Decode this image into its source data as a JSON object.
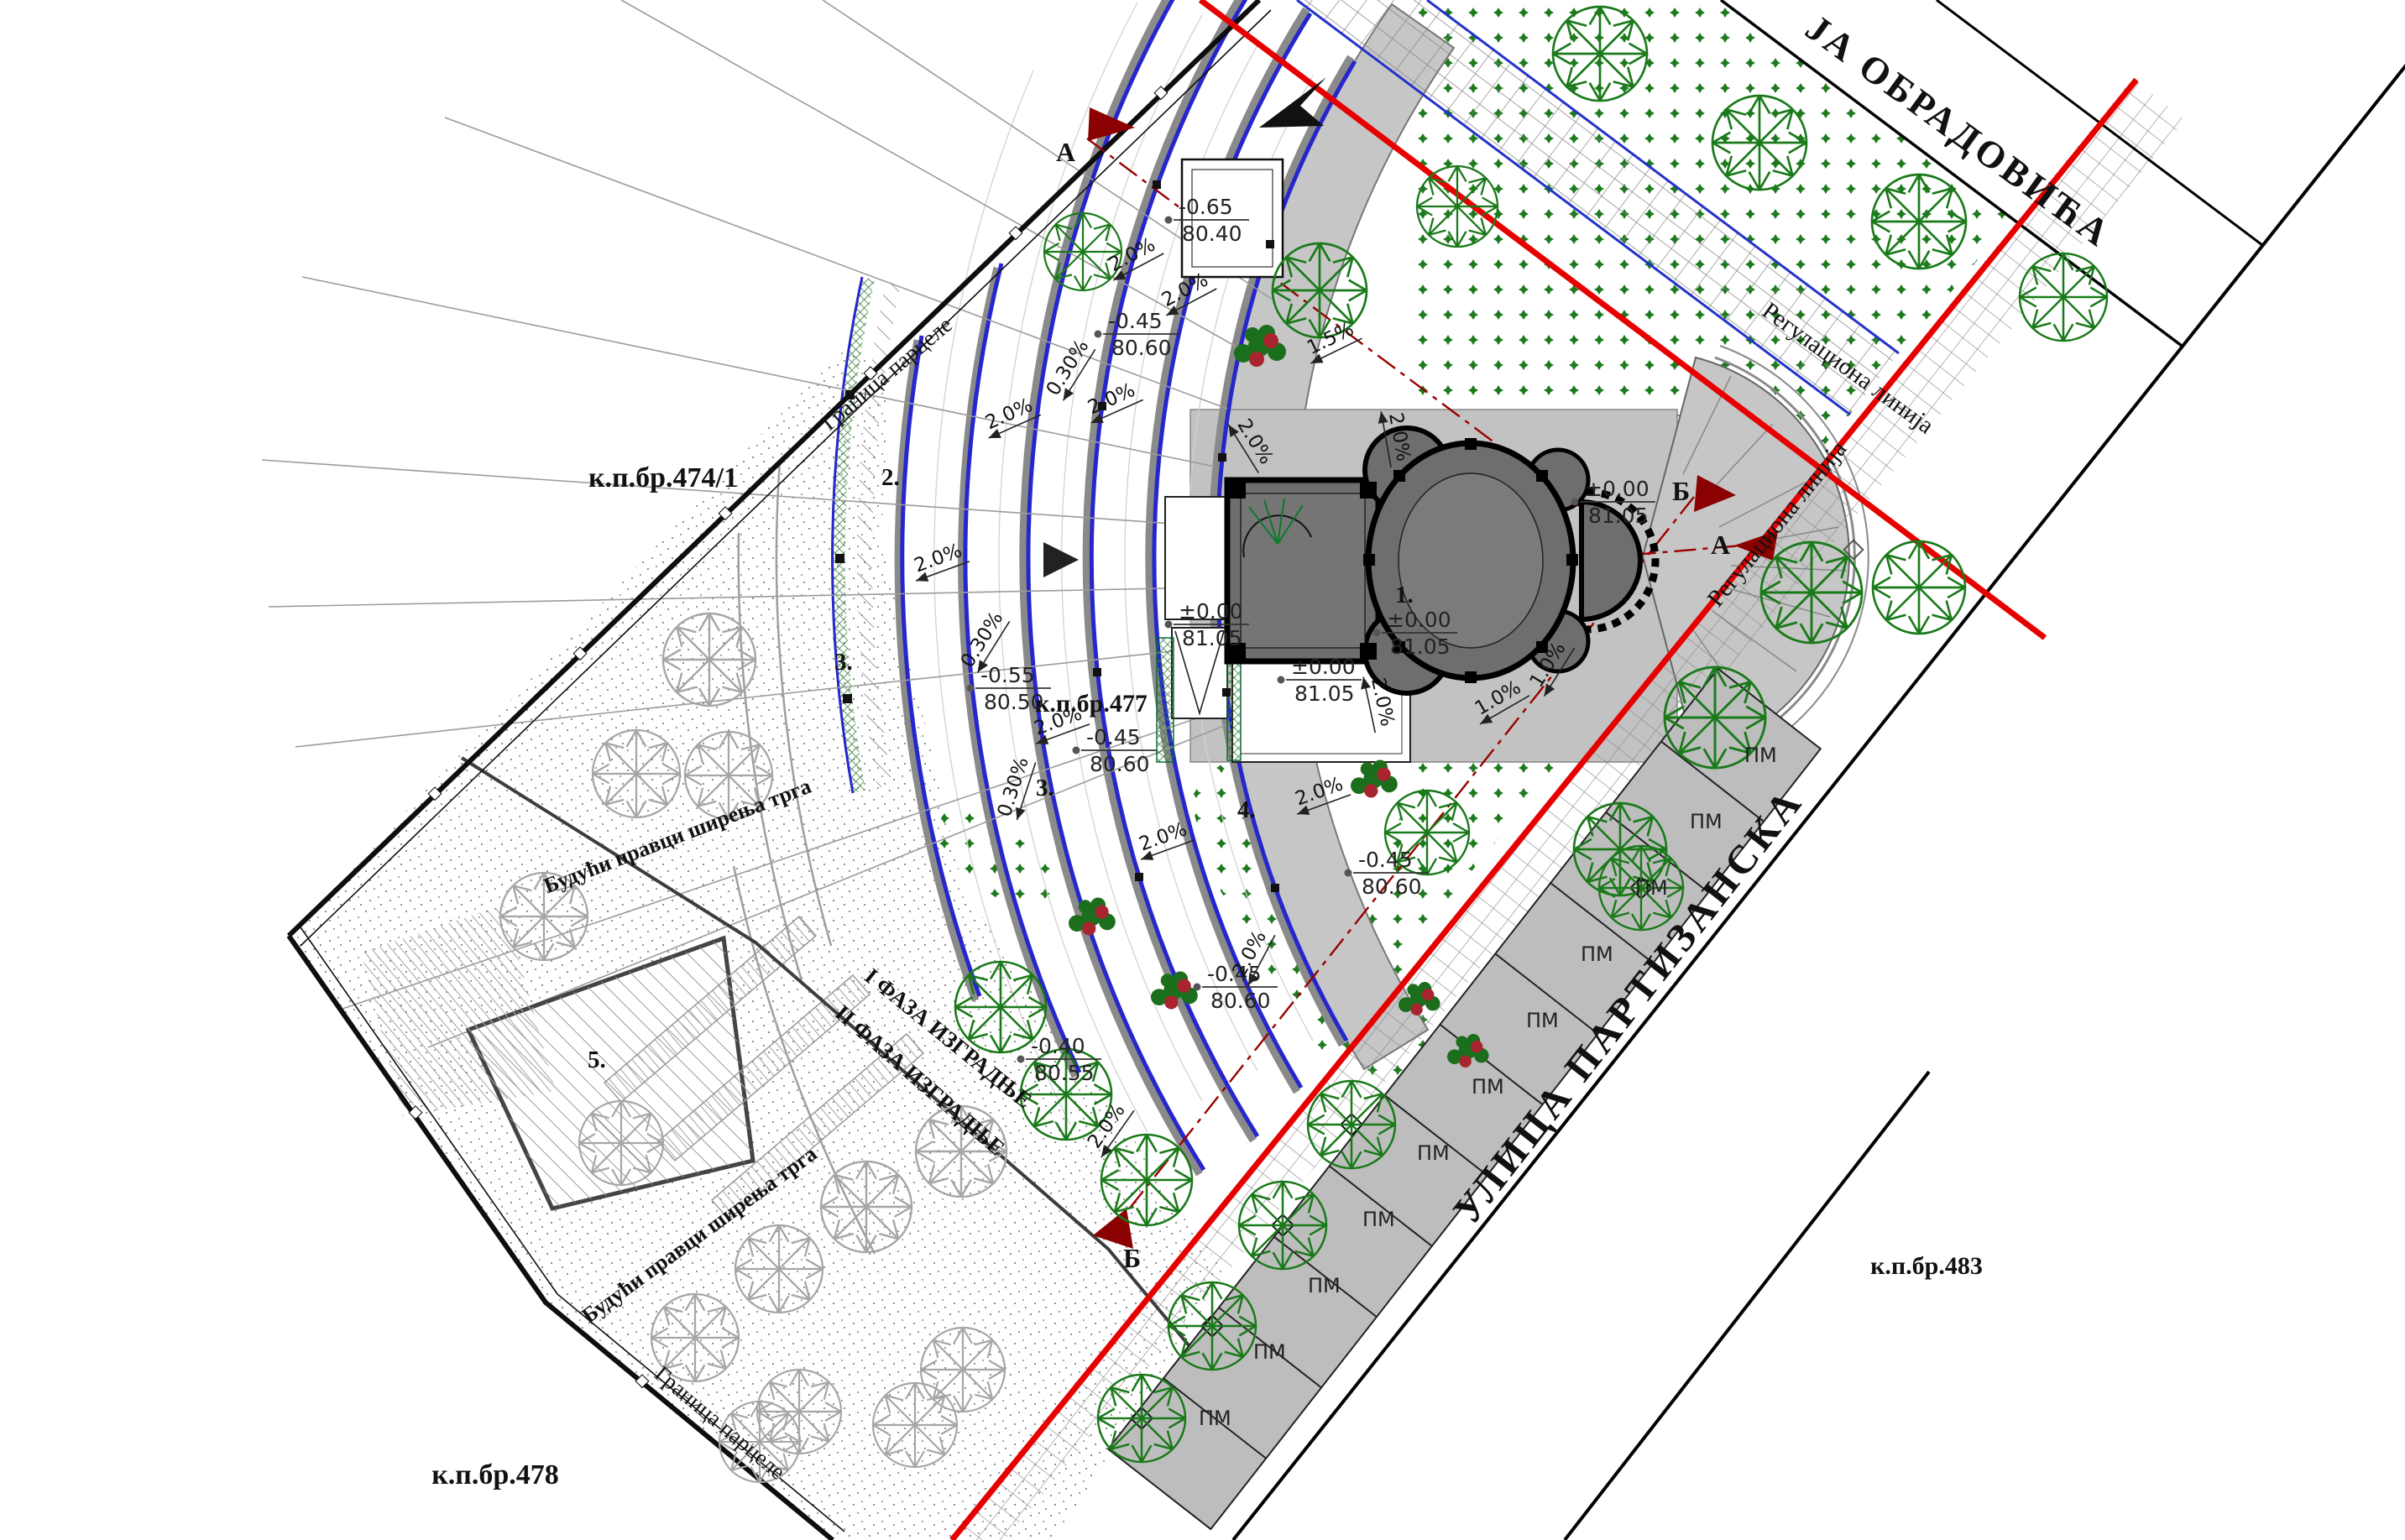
{
  "drawing": {
    "type": "site-plan",
    "subject": "church square landscaping plan"
  },
  "streets": {
    "top": {
      "label": "ЈА ОБРАДОВИЋА"
    },
    "right": {
      "label": "УЛИЦА ПАРТИЗАНСКА"
    }
  },
  "parcels": [
    {
      "label": "к.п.бр.474/1"
    },
    {
      "label": "к.п.бр.477"
    },
    {
      "label": "к.п.бр.478"
    },
    {
      "label": "к.п.бр.483"
    }
  ],
  "regulation_lines": [
    {
      "label": "Регулациона линија"
    },
    {
      "label": "Регулациона линија"
    }
  ],
  "boundary_labels": [
    {
      "label": "Граница парцеле"
    },
    {
      "label": "Граница парцеле"
    }
  ],
  "phases": [
    {
      "label": "I ФАЗА ИЗГРАДЊЕ"
    },
    {
      "label": "II ФАЗА ИЗГРАДЊЕ"
    }
  ],
  "future_directions": [
    {
      "label": "Будући правци ширења трга"
    },
    {
      "label": "Будући правци ширења трга"
    }
  ],
  "area_numbers": [
    {
      "label": "1."
    },
    {
      "label": "2."
    },
    {
      "label": "3."
    },
    {
      "label": "3."
    },
    {
      "label": "4."
    },
    {
      "label": "5."
    }
  ],
  "sections": [
    {
      "label": "А"
    },
    {
      "label": "А"
    },
    {
      "label": "Б"
    },
    {
      "label": "Б"
    }
  ],
  "parking": {
    "stall_label": "ПМ",
    "count": 11
  },
  "elevations": [
    {
      "rel": "-0.65",
      "abs": "80.40"
    },
    {
      "rel": "-0.45",
      "abs": "80.60"
    },
    {
      "rel": "-0.55",
      "abs": "80.50"
    },
    {
      "rel": "-0.45",
      "abs": "80.60"
    },
    {
      "rel": "±0.00",
      "abs": "81.05"
    },
    {
      "rel": "±0.00",
      "abs": "81.05"
    },
    {
      "rel": "±0.00",
      "abs": "81.05"
    },
    {
      "rel": "±0.00",
      "abs": "81.05"
    },
    {
      "rel": "-0.40",
      "abs": "80.55"
    },
    {
      "rel": "-0.45",
      "abs": "80.60"
    },
    {
      "rel": "-0.45",
      "abs": "80.60"
    }
  ],
  "slopes": [
    {
      "label": "2.0%"
    },
    {
      "label": "2.0%"
    },
    {
      "label": "0.30%"
    },
    {
      "label": "2.0%"
    },
    {
      "label": "2.0%"
    },
    {
      "label": "0.30%"
    },
    {
      "label": "2.0%"
    },
    {
      "label": "2.0%"
    },
    {
      "label": "2.0%"
    },
    {
      "label": "1.5%"
    },
    {
      "label": "1.0%"
    },
    {
      "label": "1.0%"
    },
    {
      "label": "2.0%"
    },
    {
      "label": "2.0%"
    },
    {
      "label": "2.0%"
    },
    {
      "label": "2.0%"
    },
    {
      "label": "2.0%"
    },
    {
      "label": "0.30%"
    },
    {
      "label": "2.0%"
    }
  ],
  "icons": {
    "tree": "deciduous-tree-plan-symbol",
    "shrub": "starburst-shrub-symbol",
    "bush": "flowering-bush-cluster",
    "north_arrow": "north-arrow",
    "section_arrow": "section-cut-arrow"
  },
  "colors": {
    "regulation_red": "#e60000",
    "section_red": "#8b0000",
    "step_blue": "#2626cc",
    "bench_green": "#2e7d32",
    "tree_green": "#1a7a1a",
    "plaza_gray": "#c6c6c6"
  }
}
